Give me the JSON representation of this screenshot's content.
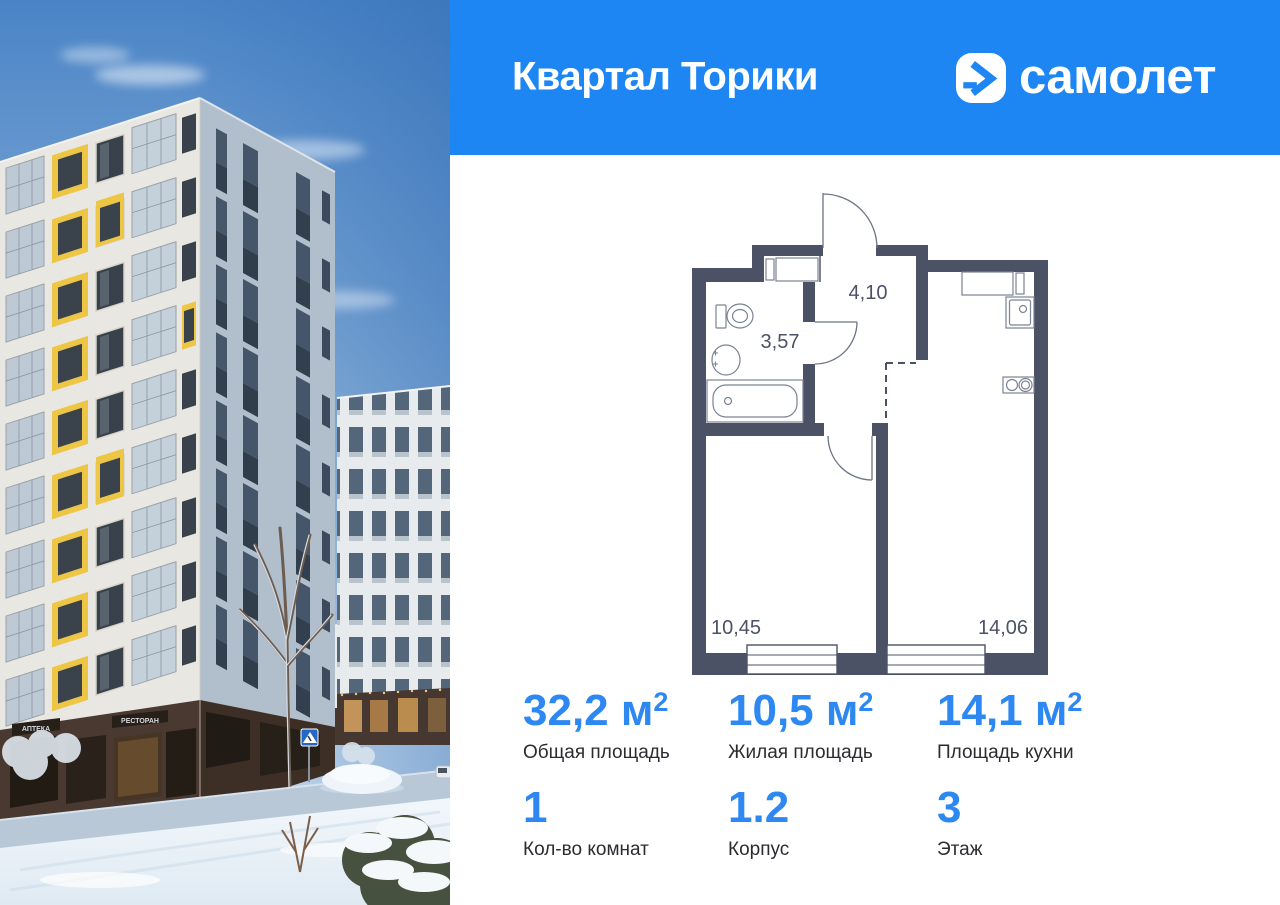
{
  "colors": {
    "header_blue": "#1d86f3",
    "accent_blue": "#2e88f1",
    "plan_wall": "#4c5266",
    "facade_yellow": "#eec645"
  },
  "header": {
    "project_title": "Квартал Торики",
    "brand": "самолет"
  },
  "photo": {
    "sign_pharmacy": "АПТЕКА",
    "sign_restaurant": "РЕСТОРАН"
  },
  "floor_plan": {
    "areas": {
      "hallway": "4,10",
      "bathroom": "3,57",
      "living": "10,45",
      "kitchen": "14,06"
    }
  },
  "stats": {
    "row1": [
      {
        "value": "32,2 м",
        "sup": "2",
        "label": "Общая площадь"
      },
      {
        "value": "10,5 м",
        "sup": "2",
        "label": "Жилая площадь"
      },
      {
        "value": "14,1 м",
        "sup": "2",
        "label": "Площадь кухни"
      }
    ],
    "row2": [
      {
        "value": "1",
        "label": "Кол-во комнат"
      },
      {
        "value": "1.2",
        "label": "Корпус"
      },
      {
        "value": "3",
        "label": "Этаж"
      }
    ]
  }
}
